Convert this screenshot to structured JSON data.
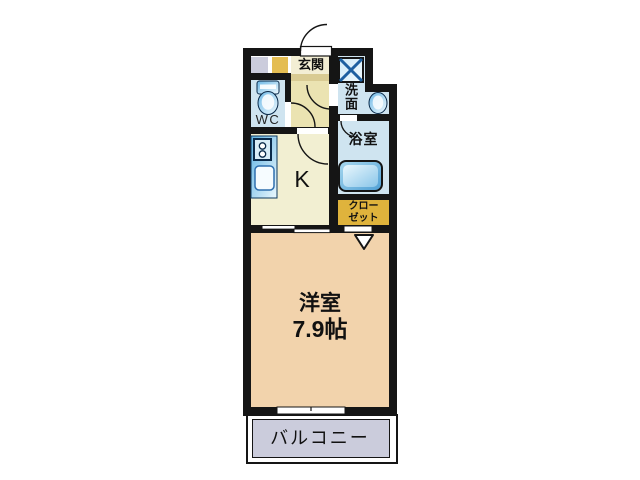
{
  "floorplan": {
    "type": "apartment-floor-plan",
    "rooms": {
      "entrance": {
        "label": "玄関"
      },
      "washroom": {
        "label": "洗面"
      },
      "wc": {
        "label": "WC"
      },
      "bathroom": {
        "label": "浴室"
      },
      "kitchen": {
        "label": "K"
      },
      "closet": {
        "label_line1": "クロー",
        "label_line2": "ゼット"
      },
      "western_room": {
        "label": "洋室",
        "size": "7.9帖"
      },
      "balcony": {
        "label": "バルコニー"
      }
    },
    "colors": {
      "wall": "#151515",
      "room_peach": "#f2d3ac",
      "kitchen_yellow": "#f2efd2",
      "hall_yellow": "#ebe3b2",
      "light_blue": "#cfe4f0",
      "gold": "#dfb33c",
      "lavender": "#cbccdc",
      "fixture_blue": "#55abdd",
      "fixture_navy": "#1d5fa0"
    }
  }
}
